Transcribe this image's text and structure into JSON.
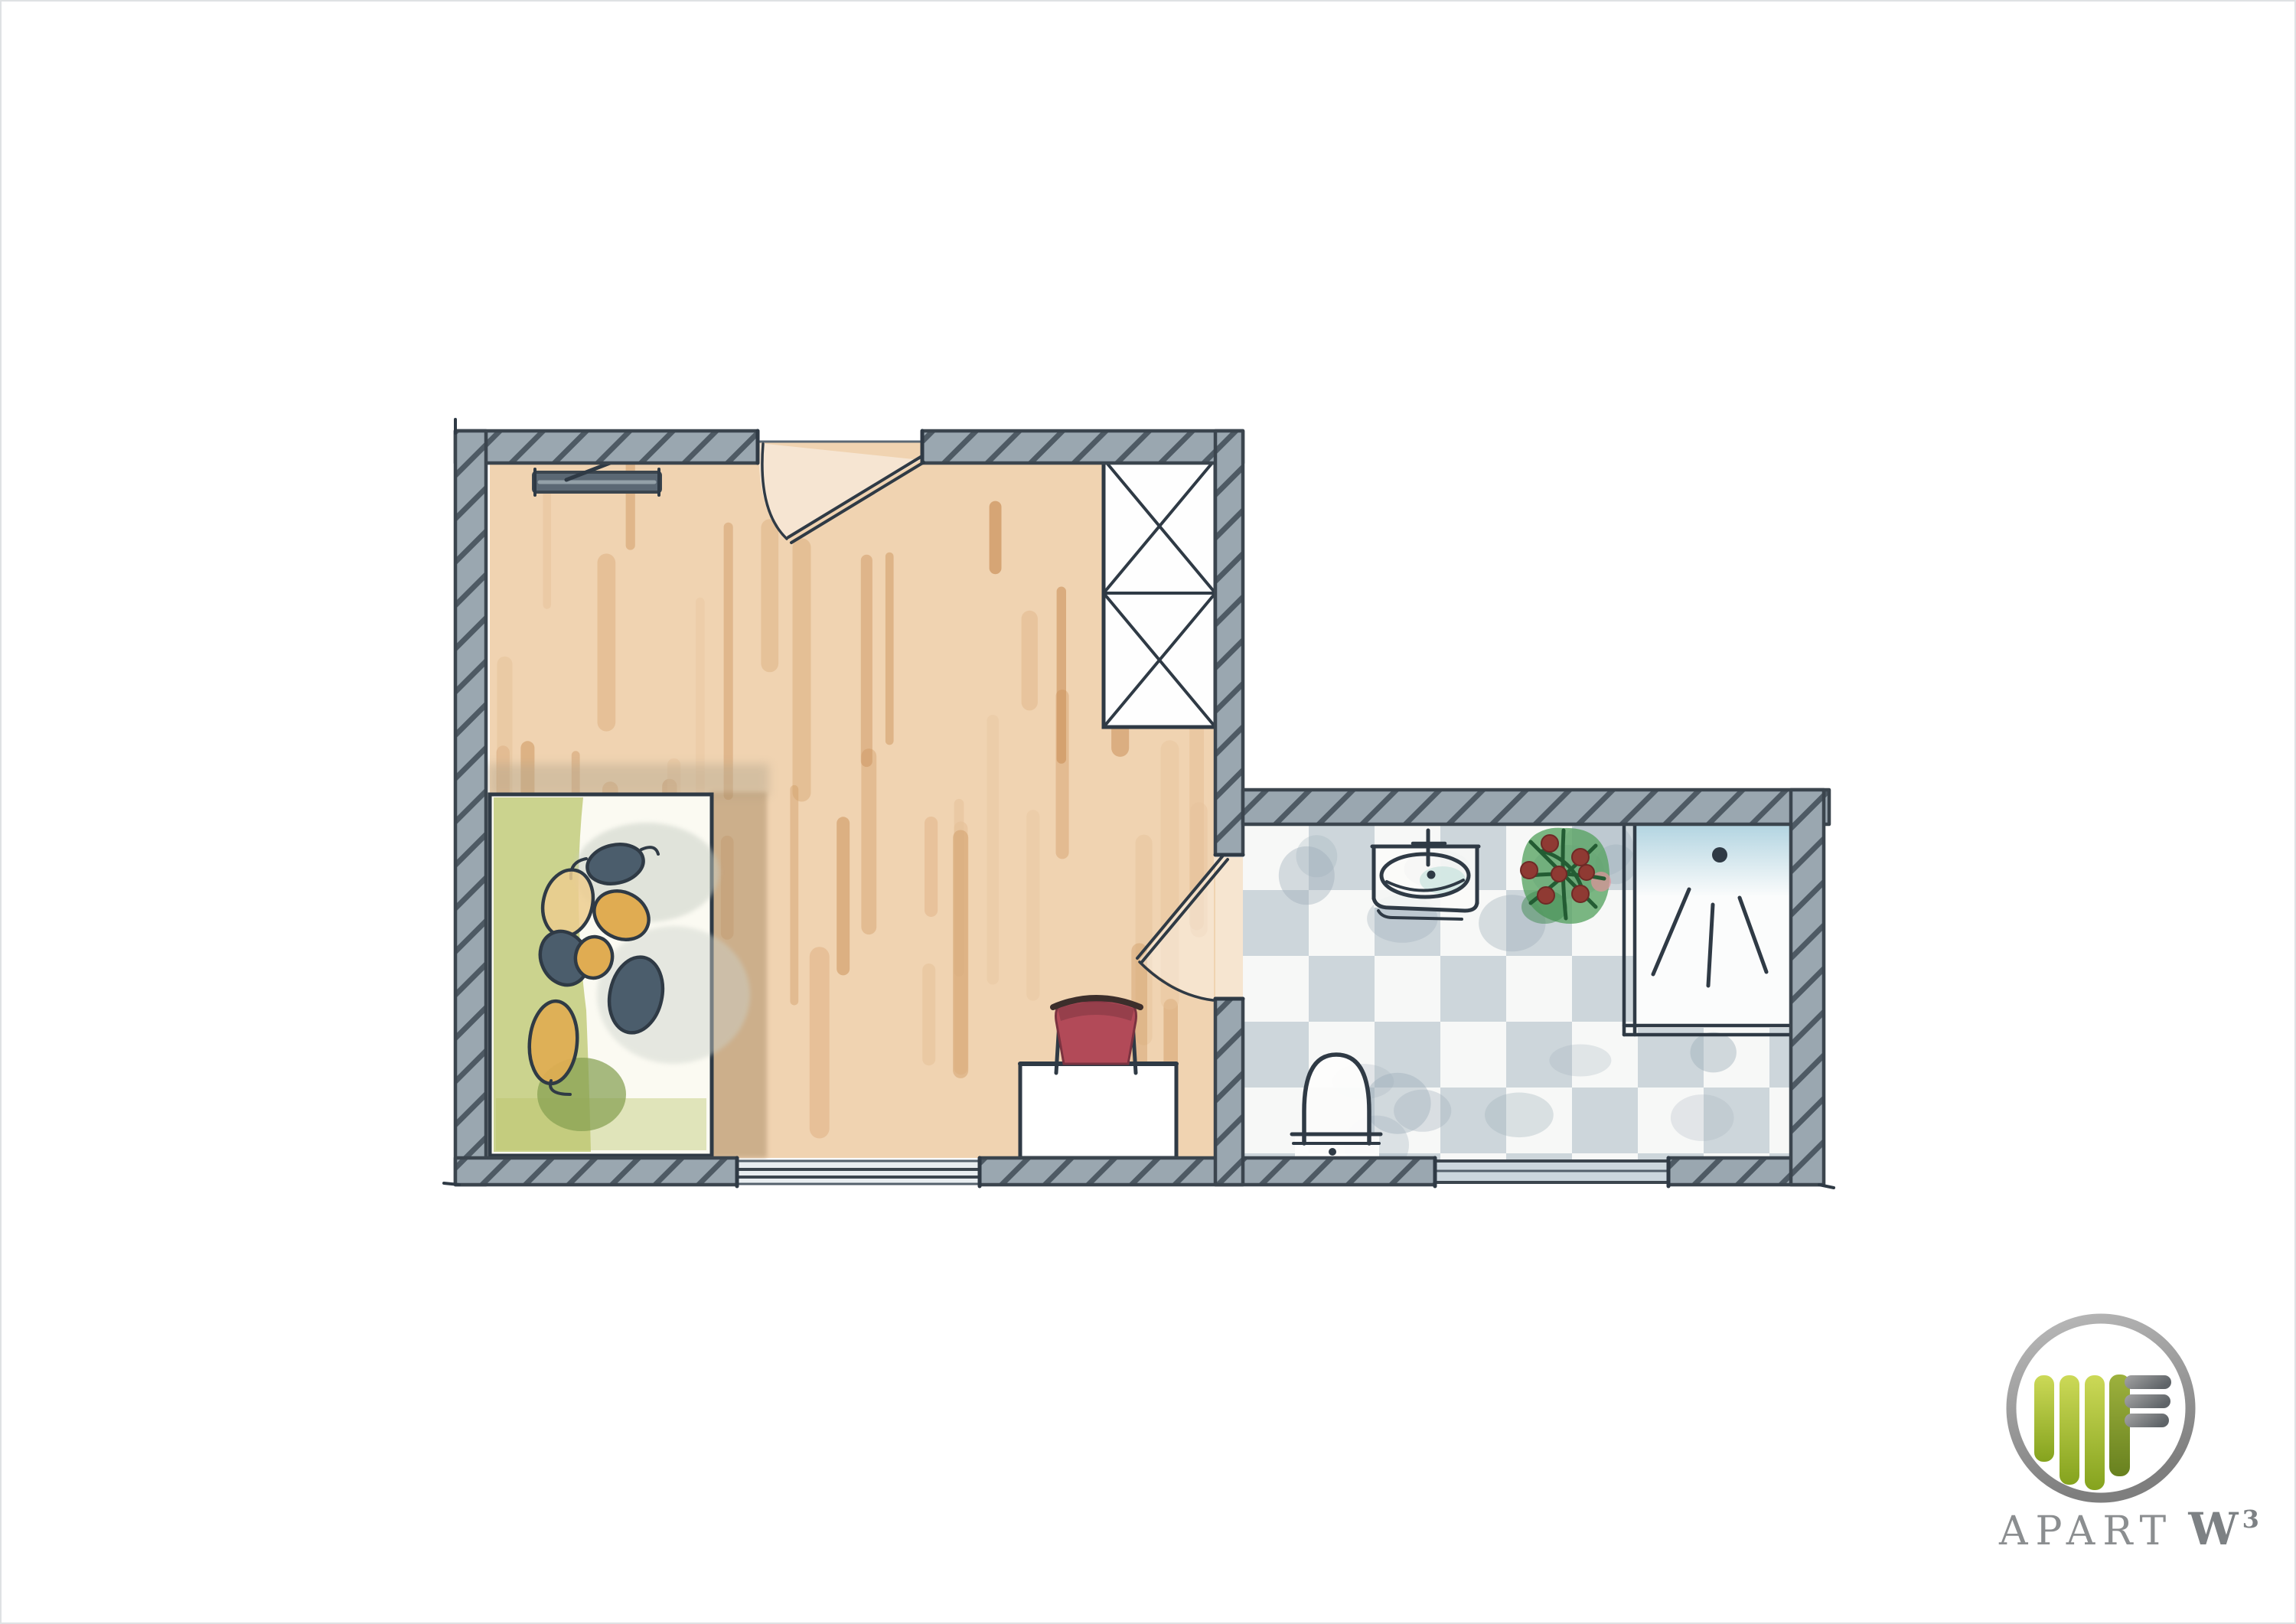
{
  "logo": {
    "brand": "APART",
    "mark": "W",
    "mark_superscript": "3"
  },
  "colors": {
    "paper": "#ffffff",
    "wall_base": "#9aa7b0",
    "wall_hatch": "#4e5a64",
    "wall_line": "#3b454e",
    "pencil": "#2f3a45",
    "wood_base": "#f0d3b1",
    "wood_streak_1": "#ddae7f",
    "wood_streak_2": "#d09a64",
    "wood_streak_3": "#c68a52",
    "wood_streak_4": "#e6c29a",
    "bed_fill": "#fbfaf2",
    "bed_green": "#b8c366",
    "bed_green_dark": "#85a050",
    "leaf_slate": "#4b5d6c",
    "leaf_ochre": "#e0ac52",
    "leaf_cream": "#eccd8f",
    "shadow_tan": "#a98c67",
    "shadow_gray": "#b4a78e",
    "stool_red": "#b24a58",
    "stool_red_dark": "#8e3c49",
    "stool_rim": "#3c2e2b",
    "tile_white": "#f7f8f7",
    "tile_gray": "#c3cdd4",
    "tile_blotch": "#9dadb9",
    "window_glass": "#ccd7de",
    "window_glass_light": "#e8edf0",
    "shower_blue": "#a5cddc",
    "plant_green": "#57a362",
    "plant_stem": "#235c33",
    "plant_berry": "#8f3a33",
    "plant_pink": "#e2939b",
    "fixture_white": "#fdfdfc",
    "sink_aqua": "#bfe0da",
    "radiator_fill": "#5b6874",
    "radiator_slit": "#93a0a8",
    "logo_green_light": "#ccd957",
    "logo_green_dark": "#85a31e",
    "logo_olive_light": "#9db13d",
    "logo_olive_dark": "#68811f",
    "logo_gray_light": "#a4a4a4",
    "logo_gray_dark": "#5f6468",
    "logo_ring_light": "#bababa",
    "logo_ring_dark": "#7e7e7e",
    "logo_text": "#8b8e90"
  }
}
